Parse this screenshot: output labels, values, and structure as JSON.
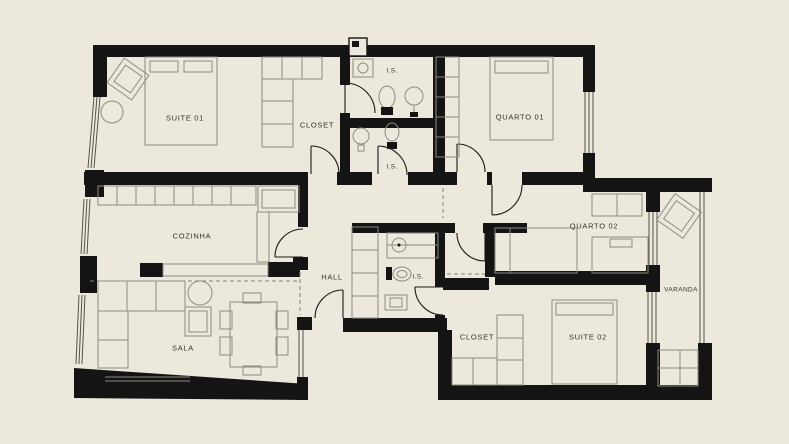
{
  "plan": {
    "type": "apartment-floor-plan",
    "background_color": "#ECE8DB",
    "wall_color": "#141414",
    "furniture_line_color": "#8d8d82",
    "door_line_color": "#1a1a1a",
    "label_color": "#33322c",
    "rooms": [
      {
        "id": "suite-01",
        "label": "SUITE 01",
        "x": 185,
        "y": 118
      },
      {
        "id": "closet-suite-01",
        "label": "CLOSET",
        "x": 317,
        "y": 125
      },
      {
        "id": "is-1",
        "label": "I.S.",
        "x": 392,
        "y": 71
      },
      {
        "id": "is-2",
        "label": "I.S.",
        "x": 392,
        "y": 167
      },
      {
        "id": "quarto-01",
        "label": "QUARTO 01",
        "x": 520,
        "y": 117
      },
      {
        "id": "cozinha",
        "label": "COZINHA",
        "x": 192,
        "y": 236
      },
      {
        "id": "hall",
        "label": "HALL",
        "x": 332,
        "y": 277
      },
      {
        "id": "is-3",
        "label": "I.S.",
        "x": 418,
        "y": 277
      },
      {
        "id": "quarto-02",
        "label": "QUARTO 02",
        "x": 594,
        "y": 226
      },
      {
        "id": "varanda",
        "label": "VARANDA",
        "x": 681,
        "y": 290
      },
      {
        "id": "sala",
        "label": "SALA",
        "x": 183,
        "y": 348
      },
      {
        "id": "closet-suite-02",
        "label": "CLOSET",
        "x": 477,
        "y": 337
      },
      {
        "id": "suite-02",
        "label": "SUITE 02",
        "x": 588,
        "y": 337
      }
    ]
  }
}
